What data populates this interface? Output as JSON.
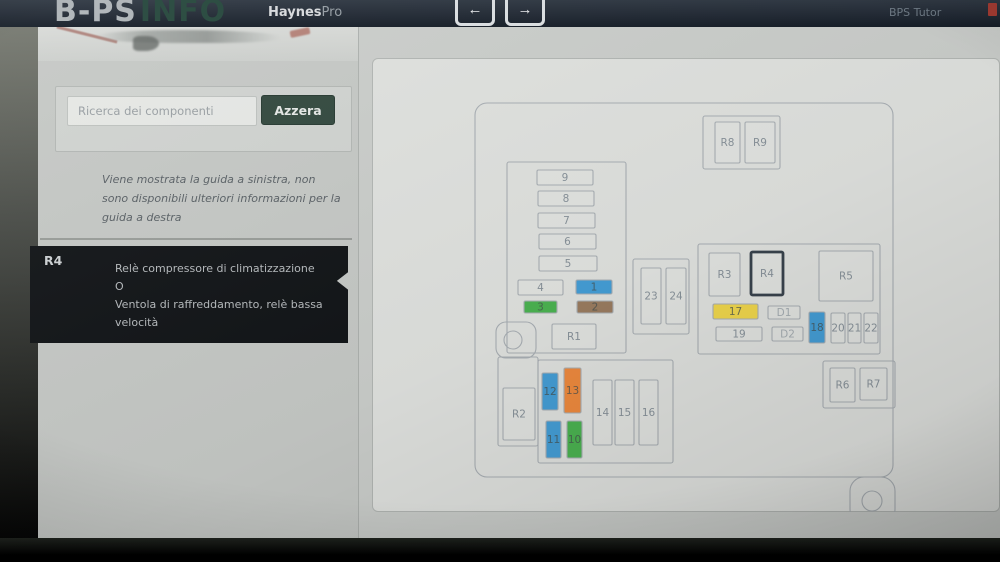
{
  "navbar": {
    "logo_primary": "B-PS",
    "logo_secondary": "INFO",
    "brand_bold": "Haynes",
    "brand_light": "Pro",
    "back_arrow": "←",
    "forward_arrow": "→",
    "right_link": "BPS Tutor"
  },
  "sidebar": {
    "search": {
      "placeholder": "Ricerca dei componenti",
      "clear_label": "Azzera"
    },
    "notice": "Viene mostrata la guida a sinistra, non sono disponibili ulteriori informazioni per la guida a destra",
    "component": {
      "code": "R4",
      "description_lines": [
        "Relè compressore di climatizzazione",
        "O",
        "Ventola di raffreddamento, relè bassa velocità"
      ]
    }
  },
  "diagram": {
    "palette": {
      "blue": "#459ed6",
      "green": "#4bb351",
      "brown": "#9a7c60",
      "orange": "#ee8a3e",
      "yellow": "#f0d74c",
      "white": "#e2e4e1"
    },
    "stroke": "#a9afb4",
    "label_color": "#88929a",
    "label_on_color": "#46504f",
    "label_faint": "#a5adb2",
    "selected_stroke": "#39434d",
    "containers": [
      {
        "name": "fusebox-outline",
        "x": 105,
        "y": 45,
        "w": 418,
        "h": 374,
        "rx": 12
      },
      {
        "name": "relay-group-top",
        "x": 333,
        "y": 58,
        "w": 77,
        "h": 53,
        "rx": 2
      },
      {
        "name": "fuse-column-box",
        "x": 137,
        "y": 104,
        "w": 119,
        "h": 191,
        "rx": 2
      },
      {
        "name": "fuse-23-24-box",
        "x": 263,
        "y": 201,
        "w": 56,
        "h": 75,
        "rx": 2
      },
      {
        "name": "relay-panel-right",
        "x": 328,
        "y": 186,
        "w": 182,
        "h": 110,
        "rx": 2
      },
      {
        "name": "relay-group-bottom-right",
        "x": 453,
        "y": 303,
        "w": 72,
        "h": 47,
        "rx": 2
      },
      {
        "name": "lower-compartment",
        "x": 168,
        "y": 302,
        "w": 135,
        "h": 103,
        "rx": 2
      },
      {
        "name": "r2-pocket",
        "x": 128,
        "y": 299,
        "w": 40,
        "h": 89,
        "rx": 2
      }
    ],
    "mount_tabs": [
      {
        "name": "mount-tab-left",
        "x": 126,
        "y": 264,
        "w": 40,
        "h": 36,
        "rx": 10,
        "cx": 143,
        "cy": 282,
        "r": 9
      },
      {
        "name": "mount-tab-bottom",
        "x": 480,
        "y": 419,
        "w": 45,
        "h": 46,
        "rx": 14,
        "cx": 502,
        "cy": 443,
        "r": 10
      }
    ],
    "cells": [
      {
        "label": "R8",
        "x": 345,
        "y": 64,
        "w": 25,
        "h": 41,
        "kind": "relay"
      },
      {
        "label": "R9",
        "x": 375,
        "y": 64,
        "w": 30,
        "h": 41,
        "kind": "relay"
      },
      {
        "label": "9",
        "x": 167,
        "y": 112,
        "w": 56,
        "h": 15,
        "kind": "fuse"
      },
      {
        "label": "8",
        "x": 168,
        "y": 133,
        "w": 56,
        "h": 15,
        "kind": "fuse"
      },
      {
        "label": "7",
        "x": 168,
        "y": 155,
        "w": 57,
        "h": 15,
        "kind": "fuse"
      },
      {
        "label": "6",
        "x": 169,
        "y": 176,
        "w": 57,
        "h": 15,
        "kind": "fuse"
      },
      {
        "label": "5",
        "x": 169,
        "y": 198,
        "w": 58,
        "h": 15,
        "kind": "fuse"
      },
      {
        "label": "4",
        "x": 148,
        "y": 222,
        "w": 45,
        "h": 15,
        "kind": "fuse"
      },
      {
        "label": "1",
        "x": 206,
        "y": 222,
        "w": 36,
        "h": 14,
        "kind": "fuse",
        "color": "blue"
      },
      {
        "label": "3",
        "x": 154,
        "y": 243,
        "w": 33,
        "h": 12,
        "kind": "fuse",
        "color": "green"
      },
      {
        "label": "2",
        "x": 207,
        "y": 243,
        "w": 36,
        "h": 12,
        "kind": "fuse",
        "color": "brown"
      },
      {
        "label": "R1",
        "x": 182,
        "y": 266,
        "w": 44,
        "h": 25,
        "kind": "relay"
      },
      {
        "label": "23",
        "x": 271,
        "y": 210,
        "w": 20,
        "h": 56,
        "kind": "fuse"
      },
      {
        "label": "24",
        "x": 296,
        "y": 210,
        "w": 20,
        "h": 56,
        "kind": "fuse"
      },
      {
        "label": "R3",
        "x": 339,
        "y": 195,
        "w": 31,
        "h": 43,
        "kind": "relay"
      },
      {
        "label": "R4",
        "x": 381,
        "y": 194,
        "w": 32,
        "h": 43,
        "kind": "relay",
        "selected": true
      },
      {
        "label": "R5",
        "x": 449,
        "y": 193,
        "w": 54,
        "h": 50,
        "kind": "relay"
      },
      {
        "label": "17",
        "x": 343,
        "y": 246,
        "w": 45,
        "h": 15,
        "kind": "fuse",
        "color": "yellow"
      },
      {
        "label": "D1",
        "x": 398,
        "y": 248,
        "w": 32,
        "h": 13,
        "kind": "diode",
        "faint": true
      },
      {
        "label": "19",
        "x": 346,
        "y": 269,
        "w": 46,
        "h": 14,
        "kind": "fuse"
      },
      {
        "label": "D2",
        "x": 402,
        "y": 269,
        "w": 31,
        "h": 14,
        "kind": "diode",
        "faint": true
      },
      {
        "label": "18",
        "x": 439,
        "y": 254,
        "w": 16,
        "h": 31,
        "kind": "fuse",
        "color": "blue"
      },
      {
        "label": "20",
        "x": 461,
        "y": 255,
        "w": 14,
        "h": 30,
        "kind": "fuse"
      },
      {
        "label": "21",
        "x": 478,
        "y": 255,
        "w": 13,
        "h": 30,
        "kind": "fuse"
      },
      {
        "label": "22",
        "x": 494,
        "y": 255,
        "w": 14,
        "h": 30,
        "kind": "fuse"
      },
      {
        "label": "R6",
        "x": 460,
        "y": 310,
        "w": 25,
        "h": 34,
        "kind": "relay"
      },
      {
        "label": "R7",
        "x": 490,
        "y": 310,
        "w": 27,
        "h": 32,
        "kind": "relay"
      },
      {
        "label": "R2",
        "x": 133,
        "y": 330,
        "w": 32,
        "h": 52,
        "kind": "relay"
      },
      {
        "label": "12",
        "x": 172,
        "y": 315,
        "w": 16,
        "h": 37,
        "kind": "fuse",
        "color": "blue"
      },
      {
        "label": "13",
        "x": 194,
        "y": 310,
        "w": 17,
        "h": 45,
        "kind": "fuse",
        "color": "orange"
      },
      {
        "label": "11",
        "x": 176,
        "y": 363,
        "w": 15,
        "h": 37,
        "kind": "fuse",
        "color": "blue"
      },
      {
        "label": "10",
        "x": 197,
        "y": 363,
        "w": 15,
        "h": 37,
        "kind": "fuse",
        "color": "green"
      },
      {
        "label": "14",
        "x": 223,
        "y": 322,
        "w": 19,
        "h": 65,
        "kind": "fuse"
      },
      {
        "label": "15",
        "x": 245,
        "y": 322,
        "w": 19,
        "h": 65,
        "kind": "fuse"
      },
      {
        "label": "16",
        "x": 269,
        "y": 322,
        "w": 19,
        "h": 65,
        "kind": "fuse"
      }
    ]
  }
}
